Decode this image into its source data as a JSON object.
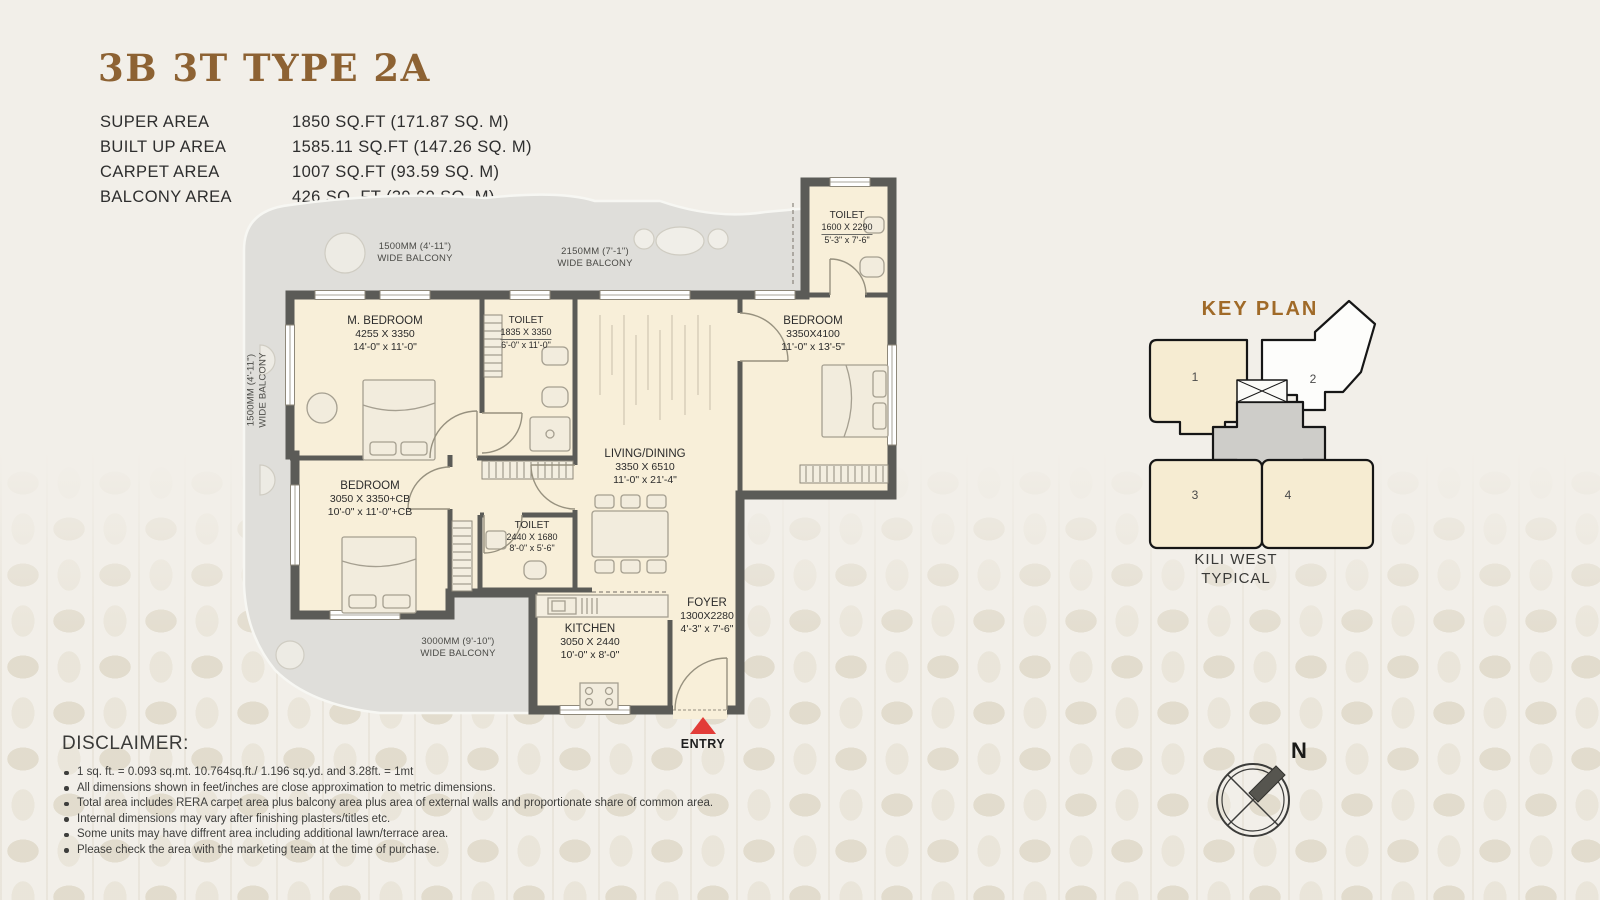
{
  "title": "3B 3T TYPE 2A",
  "colors": {
    "accent_brown": "#8d6233",
    "keyplan_brown": "#a06a28",
    "entry_red": "#e23c38",
    "wall_gray": "#5b5b57",
    "room_cream": "#f8efd9",
    "balcony_gray": "#dfdeda"
  },
  "area_table": {
    "rows": [
      {
        "label": "SUPER AREA",
        "value": "1850 SQ.FT (171.87 SQ. M)"
      },
      {
        "label": "BUILT UP AREA",
        "value": "1585.11 SQ.FT (147.26 SQ. M)"
      },
      {
        "label": "CARPET AREA",
        "value": "1007 SQ.FT (93.59 SQ. M)"
      },
      {
        "label": "BALCONY AREA",
        "value": "426 SQ. FT (39.60 SQ. M)"
      }
    ]
  },
  "plan": {
    "rooms": [
      {
        "name": "M. BEDROOM",
        "metric": "4255 X 3350",
        "imperial": "14'-0\" x 11'-0\""
      },
      {
        "name": "TOILET",
        "metric": "1835 X 3350",
        "imperial": "6'-0\" x 11'-0\""
      },
      {
        "name": "LIVING/DINING",
        "metric": "3350 X 6510",
        "imperial": "11'-0\" x 21'-4\""
      },
      {
        "name": "BEDROOM",
        "metric": "3350X4100",
        "imperial": "11'-0\" x 13'-5\""
      },
      {
        "name": "TOILET",
        "metric": "1600 X 2290",
        "imperial": "5'-3\" x 7'-6\""
      },
      {
        "name": "BEDROOM",
        "metric": "3050 X 3350+CB",
        "imperial": "10'-0\" x 11'-0\"+CB"
      },
      {
        "name": "TOILET",
        "metric": "2440 X 1680",
        "imperial": "8'-0\" x 5'-6\""
      },
      {
        "name": "KITCHEN",
        "metric": "3050 X 2440",
        "imperial": "10'-0\" x 8'-0\""
      },
      {
        "name": "FOYER",
        "metric": "1300X2280",
        "imperial": "4'-3\" x 7'-6\""
      }
    ],
    "balconies": [
      {
        "dim": "1500MM (4'-11\")",
        "label": "WIDE BALCONY"
      },
      {
        "dim": "2150MM (7'-1\")",
        "label": "WIDE BALCONY"
      },
      {
        "dim": "1500MM (4'-11\")",
        "label": "WIDE BALCONY"
      },
      {
        "dim": "3000MM (9'-10\")",
        "label": "WIDE BALCONY"
      }
    ],
    "entry_label": "ENTRY"
  },
  "key_plan": {
    "title": "KEY PLAN",
    "units": [
      "1",
      "2",
      "3",
      "4"
    ],
    "caption": [
      "KILI WEST",
      "TYPICAL"
    ]
  },
  "compass": {
    "north": "N"
  },
  "disclaimer": {
    "title": "DISCLAIMER:",
    "items": [
      "1 sq. ft. = 0.093 sq.mt. 10.764sq.ft./ 1.196 sq.yd. and 3.28ft. = 1mt",
      "All dimensions shown in feet/inches are close approximation to metric dimensions.",
      "Total area includes RERA carpet area plus balcony area plus area of external walls and proportionate share of common area.",
      "Internal dimensions may vary after finishing plasters/titles etc.",
      "Some units may have diffrent area including additional lawn/terrace area.",
      "Please check the area with the marketing team at the time of purchase."
    ]
  }
}
